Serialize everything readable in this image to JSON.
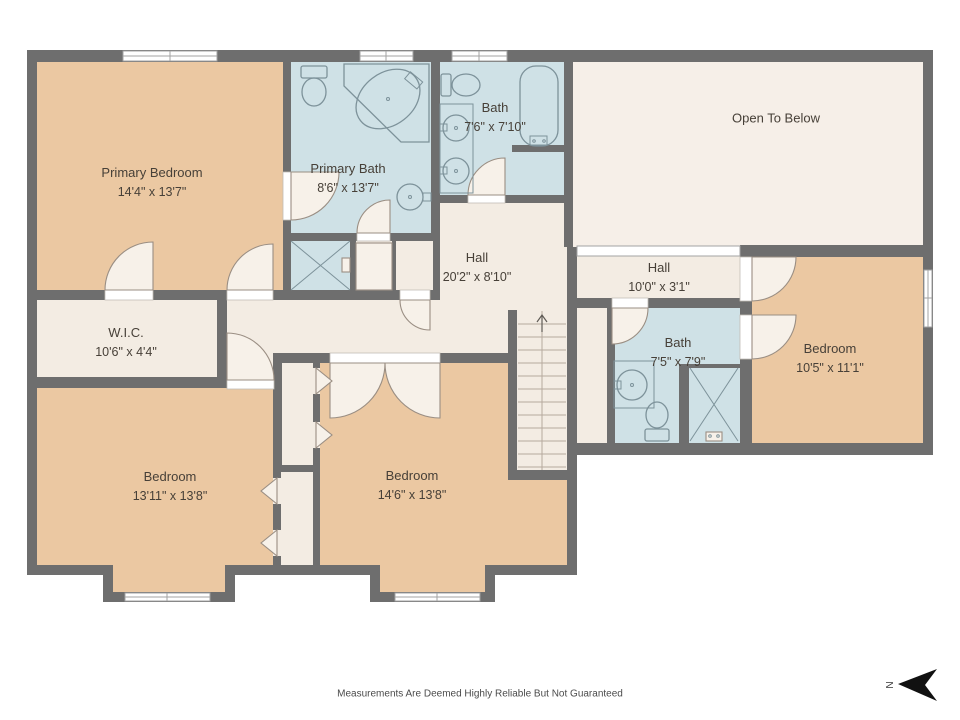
{
  "palette": {
    "wall": "#6e6e6e",
    "bedroom": "#ebc8a2",
    "bathroom": "#cfe1e6",
    "hall": "#f3ece3",
    "open_to_below": "#f6efe8",
    "fixture_outline": "#7d929a",
    "door_arc_fill": "#f7f1e9",
    "door_arc_stroke": "#9a8e83",
    "label_text": "#474038",
    "compass": "#111111"
  },
  "compass": {
    "label": "N"
  },
  "footer": {
    "disclaimer": "Measurements Are Deemed Highly Reliable But Not Guaranteed"
  },
  "rooms": [
    {
      "id": "primary-bedroom",
      "name": "Primary Bedroom",
      "dims": "14'4\" x 13'7\""
    },
    {
      "id": "primary-bath",
      "name": "Primary Bath",
      "dims": "8'6\" x 13'7\""
    },
    {
      "id": "bath-top",
      "name": "Bath",
      "dims": "7'6\" x 7'10\""
    },
    {
      "id": "open-to-below",
      "name": "Open To Below",
      "dims": ""
    },
    {
      "id": "hall-main",
      "name": "Hall",
      "dims": "20'2\" x 8'10\""
    },
    {
      "id": "hall-upper",
      "name": "Hall",
      "dims": "10'0\" x 3'1\""
    },
    {
      "id": "wic",
      "name": "W.I.C.",
      "dims": "10'6\" x 4'4\""
    },
    {
      "id": "bath-right",
      "name": "Bath",
      "dims": "7'5\" x 7'9\""
    },
    {
      "id": "bedroom-right",
      "name": "Bedroom",
      "dims": "10'5\" x 11'1\""
    },
    {
      "id": "bedroom-left",
      "name": "Bedroom",
      "dims": "13'11\" x 13'8\""
    },
    {
      "id": "bedroom-middle",
      "name": "Bedroom",
      "dims": "14'6\" x 13'8\""
    }
  ]
}
